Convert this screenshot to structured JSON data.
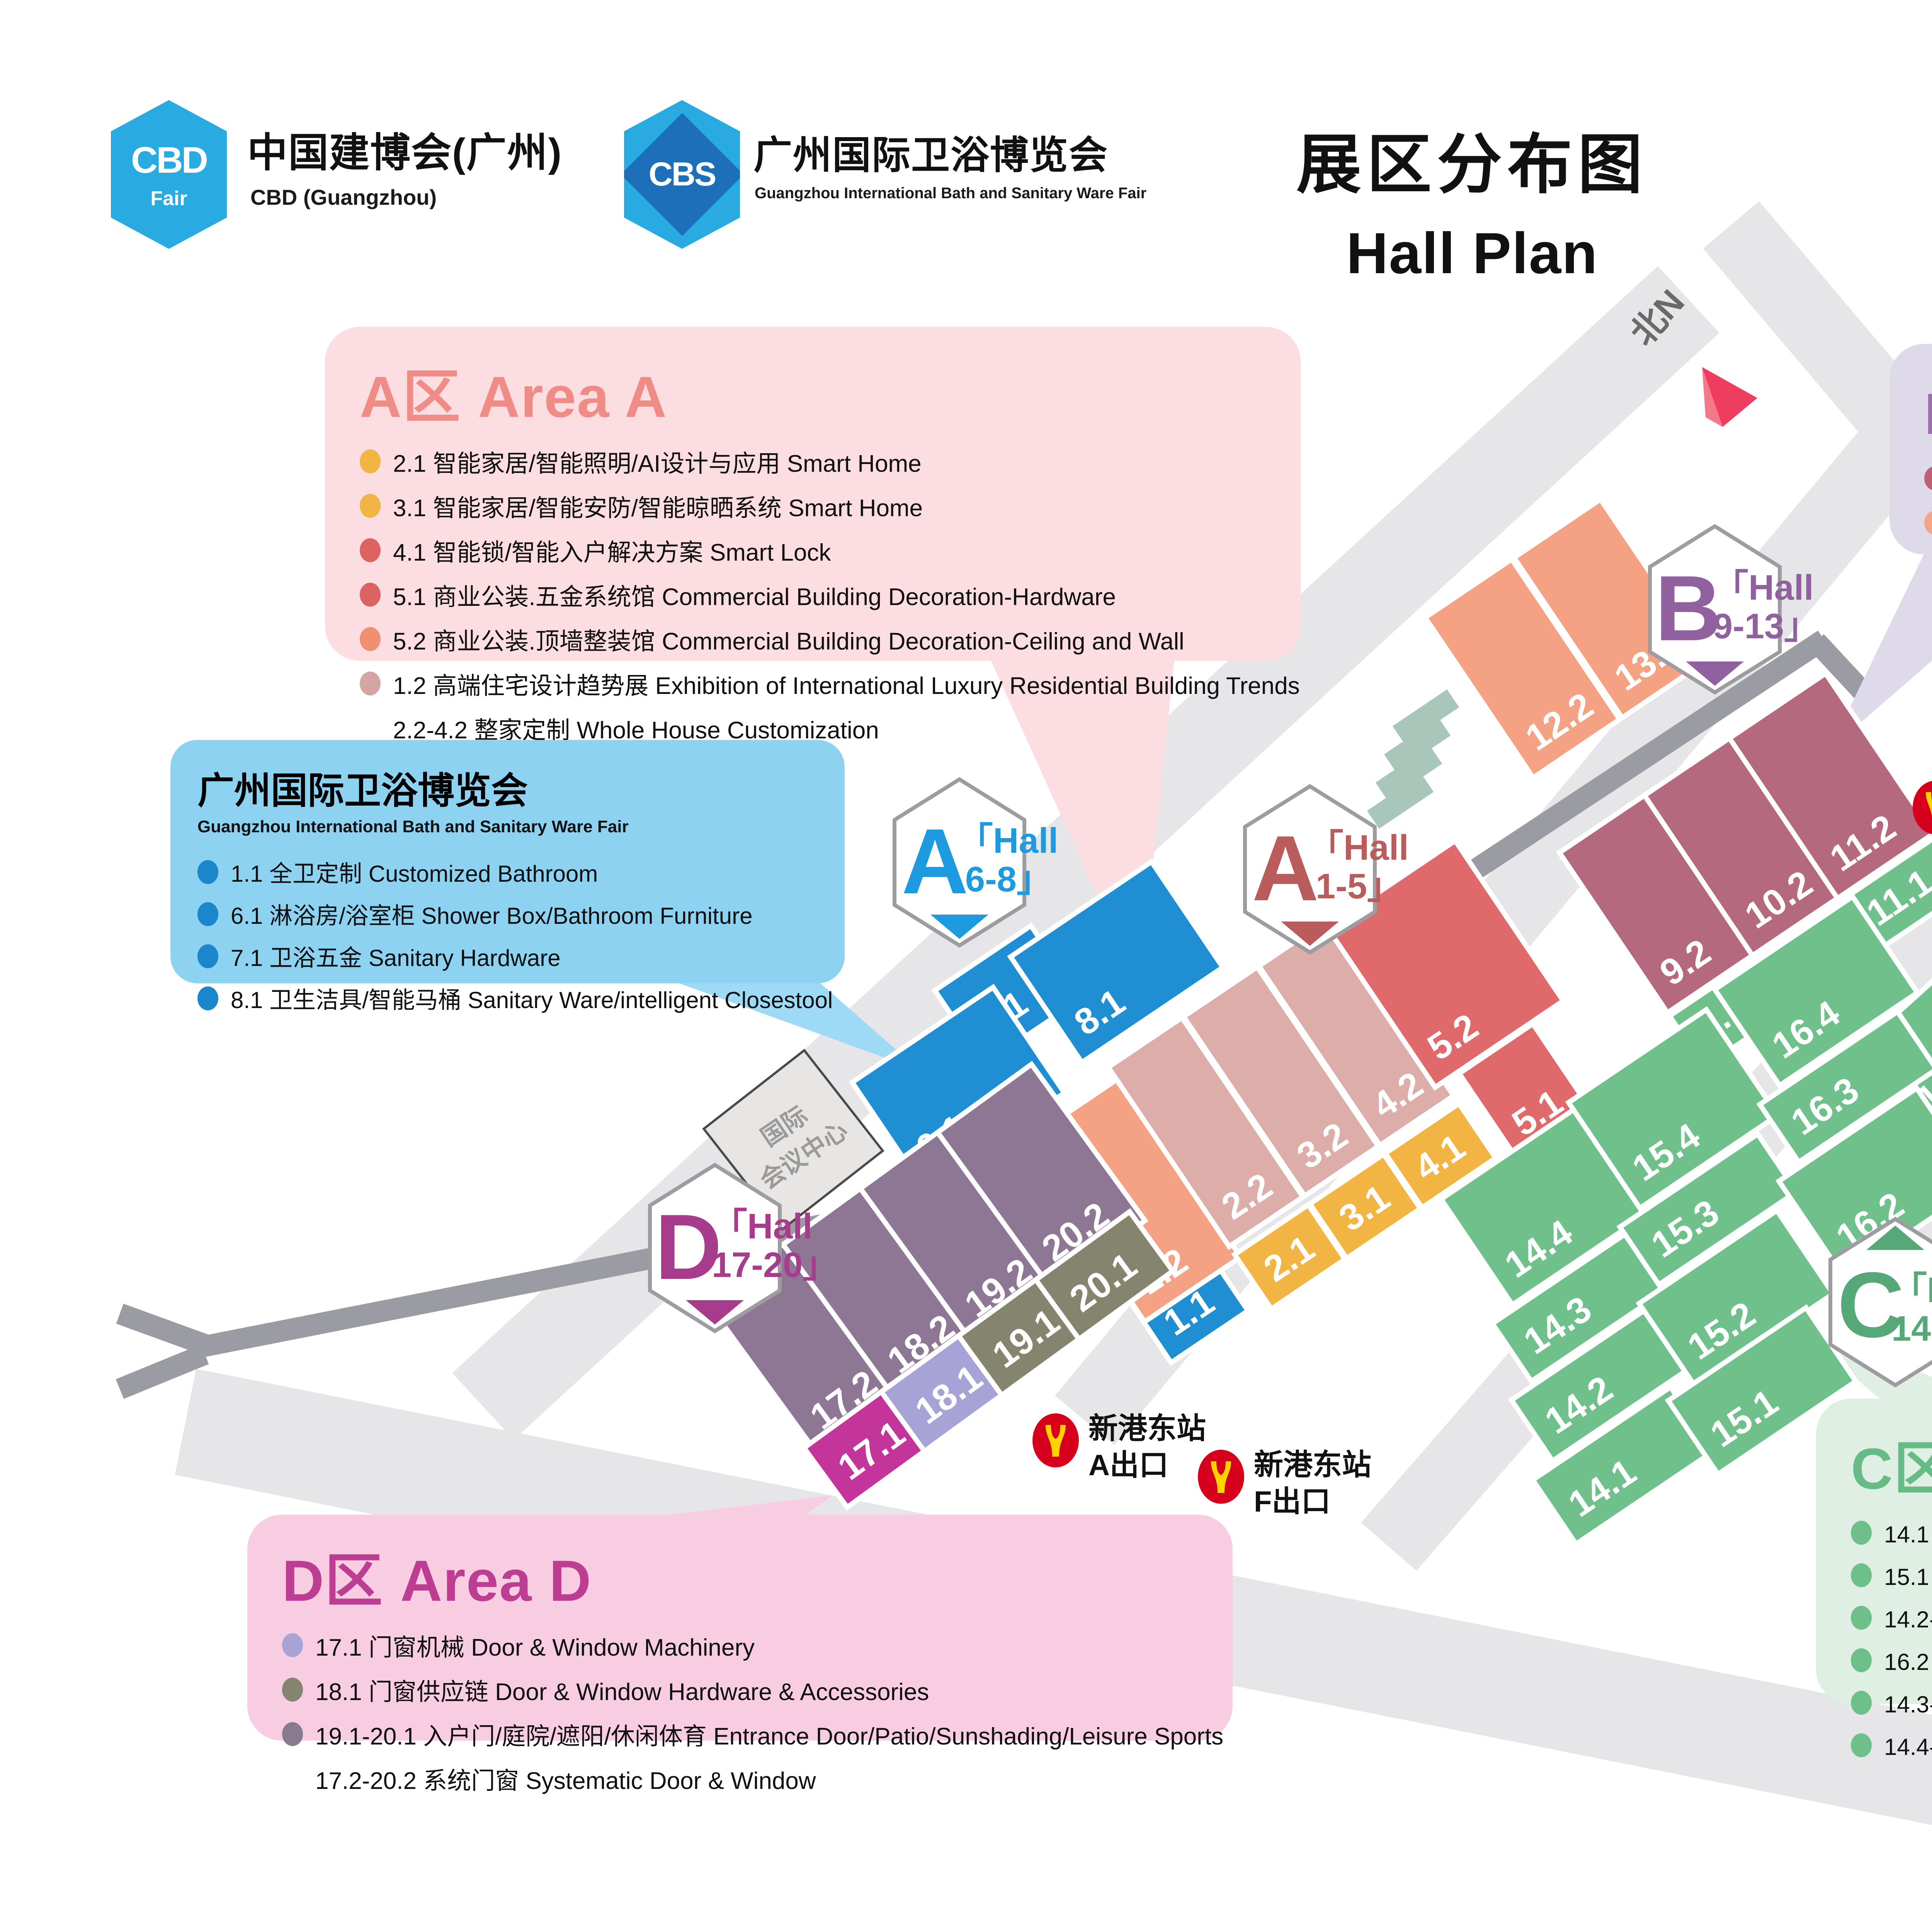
{
  "header": {
    "cbd_logo": {
      "abbr": "CBD",
      "sub": "Fair"
    },
    "cbd_title": "中国建博会(广州)",
    "cbd_subtitle": "CBD (Guangzhou)",
    "cbs_logo": {
      "abbr": "CBS"
    },
    "cbs_title": "广州国际卫浴博览会",
    "cbs_subtitle": "Guangzhou International Bath and Sanitary Ware Fair",
    "title_cn": "展区分布图",
    "title_en": "Hall Plan",
    "date": "2025.7.8-11"
  },
  "legend": {
    "area_a": {
      "title_cn": "A区",
      "title_en": "Area A",
      "items": [
        {
          "dot": "#F2B544",
          "text": "2.1 智能家居/智能照明/AI设计与应用 Smart Home"
        },
        {
          "dot": "#F2B544",
          "text": "3.1 智能家居/智能安防/智能晾晒系统 Smart Home"
        },
        {
          "dot": "#F2B544",
          "text": "4.1 智能锁/智能入户解决方案 Smart Lock"
        },
        {
          "dot": "#DD6363",
          "text": "5.1 商业公装.五金系统馆 Commercial Building Decoration-Hardware"
        },
        {
          "dot": "#DD6363",
          "text": "5.2 商业公装.顶墙整装馆 Commercial Building Decoration-Ceiling and Wall"
        },
        {
          "dot": "#F09070",
          "text": "1.2 高端住宅设计趋势展 Exhibition of International Luxury Residential Building Trends"
        },
        {
          "dot": "#D3A6A4",
          "text": "2.2-4.2 整家定制 Whole House Customization"
        }
      ]
    },
    "bath": {
      "title_cn": "广州国际卫浴博览会",
      "title_en": "Guangzhou International Bath and Sanitary Ware Fair",
      "items": [
        {
          "dot": "#1B86CC",
          "text": "1.1 全卫定制 Customized Bathroom"
        },
        {
          "dot": "#1B86CC",
          "text": "6.1 淋浴房/浴室柜 Shower Box/Bathroom Furniture"
        },
        {
          "dot": "#1B86CC",
          "text": "7.1 卫浴五金 Sanitary Hardware"
        },
        {
          "dot": "#1B86CC",
          "text": "8.1 卫生洁具/智能马桶 Sanitary Ware/intelligent Closestool"
        }
      ]
    },
    "area_b": {
      "title_cn": "B区",
      "title_en": "Area B",
      "items": [
        {
          "dot": "#6FBF8B",
          "text": "9.1-11.1 智造装备馆 Woodworking Machinery"
        },
        {
          "dot": "#BF6075",
          "text": "9.2-11.2 设计定制馆 Design Customization"
        },
        {
          "dot": "#F5A585",
          "text": "12.2-13.2 涂料软装馆 Coating & Furnishing"
        }
      ]
    },
    "area_e": {
      "badge": "保利展馆",
      "title_en": "Area E",
      "items": [
        {
          "dot": "#6FBF8B",
          "text": "21.1 工具五金 Tool & Hardware"
        },
        {
          "dot": "#6FBF8B",
          "text": "22.1 五金 Hardware"
        }
      ]
    },
    "area_c": {
      "title_cn": "C区",
      "title_en": "Area C",
      "items": [
        {
          "dot": "#6FBF8B",
          "text": "14.1 定制五金 Furniture Hardware"
        },
        {
          "dot": "#6FBF8B",
          "text": "15.1 建筑装饰五金 Decorative Hardware"
        },
        {
          "dot": "#6FBF8B",
          "text": "14.2-15.2 定制五金 Furniture Hardware"
        },
        {
          "dot": "#6FBF8B",
          "text": "16.2 材艺·国际馆 International Hall -Hardware & Material"
        },
        {
          "dot": "#6FBF8B",
          "text": "14.3-16.3 家居材料 Interior Decorative Material"
        },
        {
          "dot": "#6FBF8B",
          "text": "14.4-15.4 材料/五金 Material & Hardware"
        }
      ]
    },
    "area_d": {
      "title_cn": "D区",
      "title_en": "Area D",
      "items": [
        {
          "dot": "#C4359B",
          "text": "17.1 门窗机械  Door & Window Machinery"
        },
        {
          "dot": "#A7A3D6",
          "text": "18.1 门窗供应链  Door & Window Hardware & Accessories"
        },
        {
          "dot": "#85846F",
          "text": "19.1-20.1 入户门/庭院/遮阳/休闲体育 Entrance Door/Patio/Sunshading/Leisure Sports"
        },
        {
          "dot": "#8A7A90",
          "text": "17.2-20.2 系统门窗 Systematic Door & Window"
        }
      ]
    }
  },
  "map": {
    "north": {
      "label": "北N"
    },
    "conference": {
      "line1": "国际",
      "line2": "会议中心"
    },
    "hexagons": [
      {
        "letter": "A",
        "line1": "「Hall",
        "line2": "6-8」",
        "color": "#1D9AE0"
      },
      {
        "letter": "A",
        "line1": "「Hall",
        "line2": "1-5」",
        "color": "#BA5C5C"
      },
      {
        "letter": "B",
        "line1": "「Hall",
        "line2": "9-13」",
        "color": "#91619F"
      },
      {
        "letter": "C",
        "line1": "「Hall",
        "line2": "14-16」",
        "color": "#56A878"
      },
      {
        "letter": "D",
        "line1": "「Hall",
        "line2": "17-20」",
        "color": "#A83C8C"
      }
    ],
    "halls": [
      {
        "id": "7.1"
      },
      {
        "id": "8.1"
      },
      {
        "id": "6.1"
      },
      {
        "id": "1.1"
      },
      {
        "id": "1.2"
      },
      {
        "id": "2.2"
      },
      {
        "id": "3.2"
      },
      {
        "id": "4.2"
      },
      {
        "id": "5.2"
      },
      {
        "id": "2.1"
      },
      {
        "id": "3.1"
      },
      {
        "id": "4.1"
      },
      {
        "id": "5.1"
      },
      {
        "id": "12.2"
      },
      {
        "id": "13.2"
      },
      {
        "id": "9.2"
      },
      {
        "id": "10.2"
      },
      {
        "id": "11.2"
      },
      {
        "id": "9.1"
      },
      {
        "id": "10.1"
      },
      {
        "id": "11.1"
      },
      {
        "id": "21.1"
      },
      {
        "id": "22.1"
      },
      {
        "id": "14.4"
      },
      {
        "id": "14.3"
      },
      {
        "id": "14.2"
      },
      {
        "id": "14.1"
      },
      {
        "id": "15.4"
      },
      {
        "id": "15.3"
      },
      {
        "id": "15.2"
      },
      {
        "id": "15.1"
      },
      {
        "id": "16.4"
      },
      {
        "id": "16.3"
      },
      {
        "id": "16.2"
      },
      {
        "id": "17.2"
      },
      {
        "id": "18.2"
      },
      {
        "id": "19.2"
      },
      {
        "id": "20.2"
      },
      {
        "id": "17.1"
      },
      {
        "id": "18.1"
      },
      {
        "id": "19.1"
      },
      {
        "id": "20.1"
      }
    ],
    "stations": [
      {
        "name": "琶洲站",
        "exit": "A出口"
      },
      {
        "name": "琶洲站",
        "exit": "C出口"
      },
      {
        "name": "新港东站",
        "exit": "A出口"
      },
      {
        "name": "新港东站",
        "exit": "F出口"
      }
    ],
    "colors": {
      "hall_blue": "#1F8ED3",
      "hall_salmon": "#F5A183",
      "hall_dusty": "#DCADA9",
      "hall_red": "#E0696B",
      "hall_yellow": "#F2B544",
      "hall_mauve": "#B5697E",
      "hall_green": "#6FC08B",
      "hall_dpurple": "#8D7795",
      "hall_magenta": "#C4359B",
      "hall_periwinkle": "#A7A3D6",
      "hall_olive": "#85846F",
      "road": "#E6E6E8",
      "walkway": "#9B9BA4",
      "metro_red": "#D6001C",
      "metro_yellow": "#FFD200",
      "date_red": "#E60013"
    }
  }
}
